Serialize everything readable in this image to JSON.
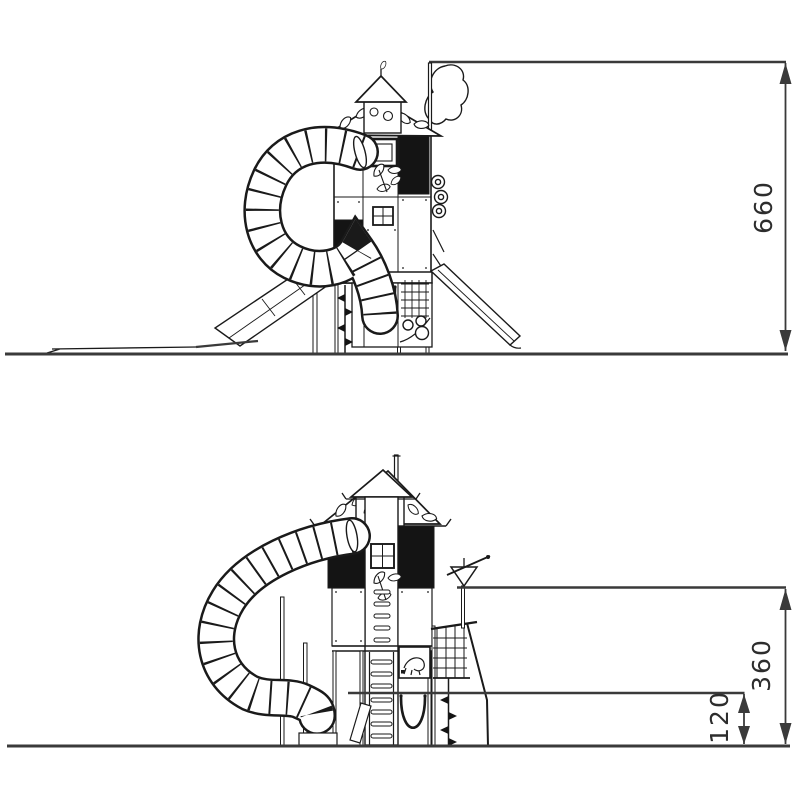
{
  "page": {
    "background_color": "#ffffff",
    "drawing_ink_color": "#1a1a1a",
    "dark_panel_color": "#141414",
    "dimension_line_color": "#3a3a3a",
    "label_text_color": "#2d2d2d"
  },
  "figures": [
    {
      "name": "upper-elevation-view",
      "subject": "playground tower with spiral tube slide, two open slides and tree mast",
      "dimensions": [
        {
          "label": "660",
          "axis": "vertical"
        }
      ]
    },
    {
      "name": "lower-elevation-view",
      "subject": "playground tower with spiral tube slide, climbing net, rope and accessories",
      "dimensions": [
        {
          "label": "360",
          "axis": "vertical"
        },
        {
          "label": "120",
          "axis": "vertical"
        }
      ]
    }
  ]
}
